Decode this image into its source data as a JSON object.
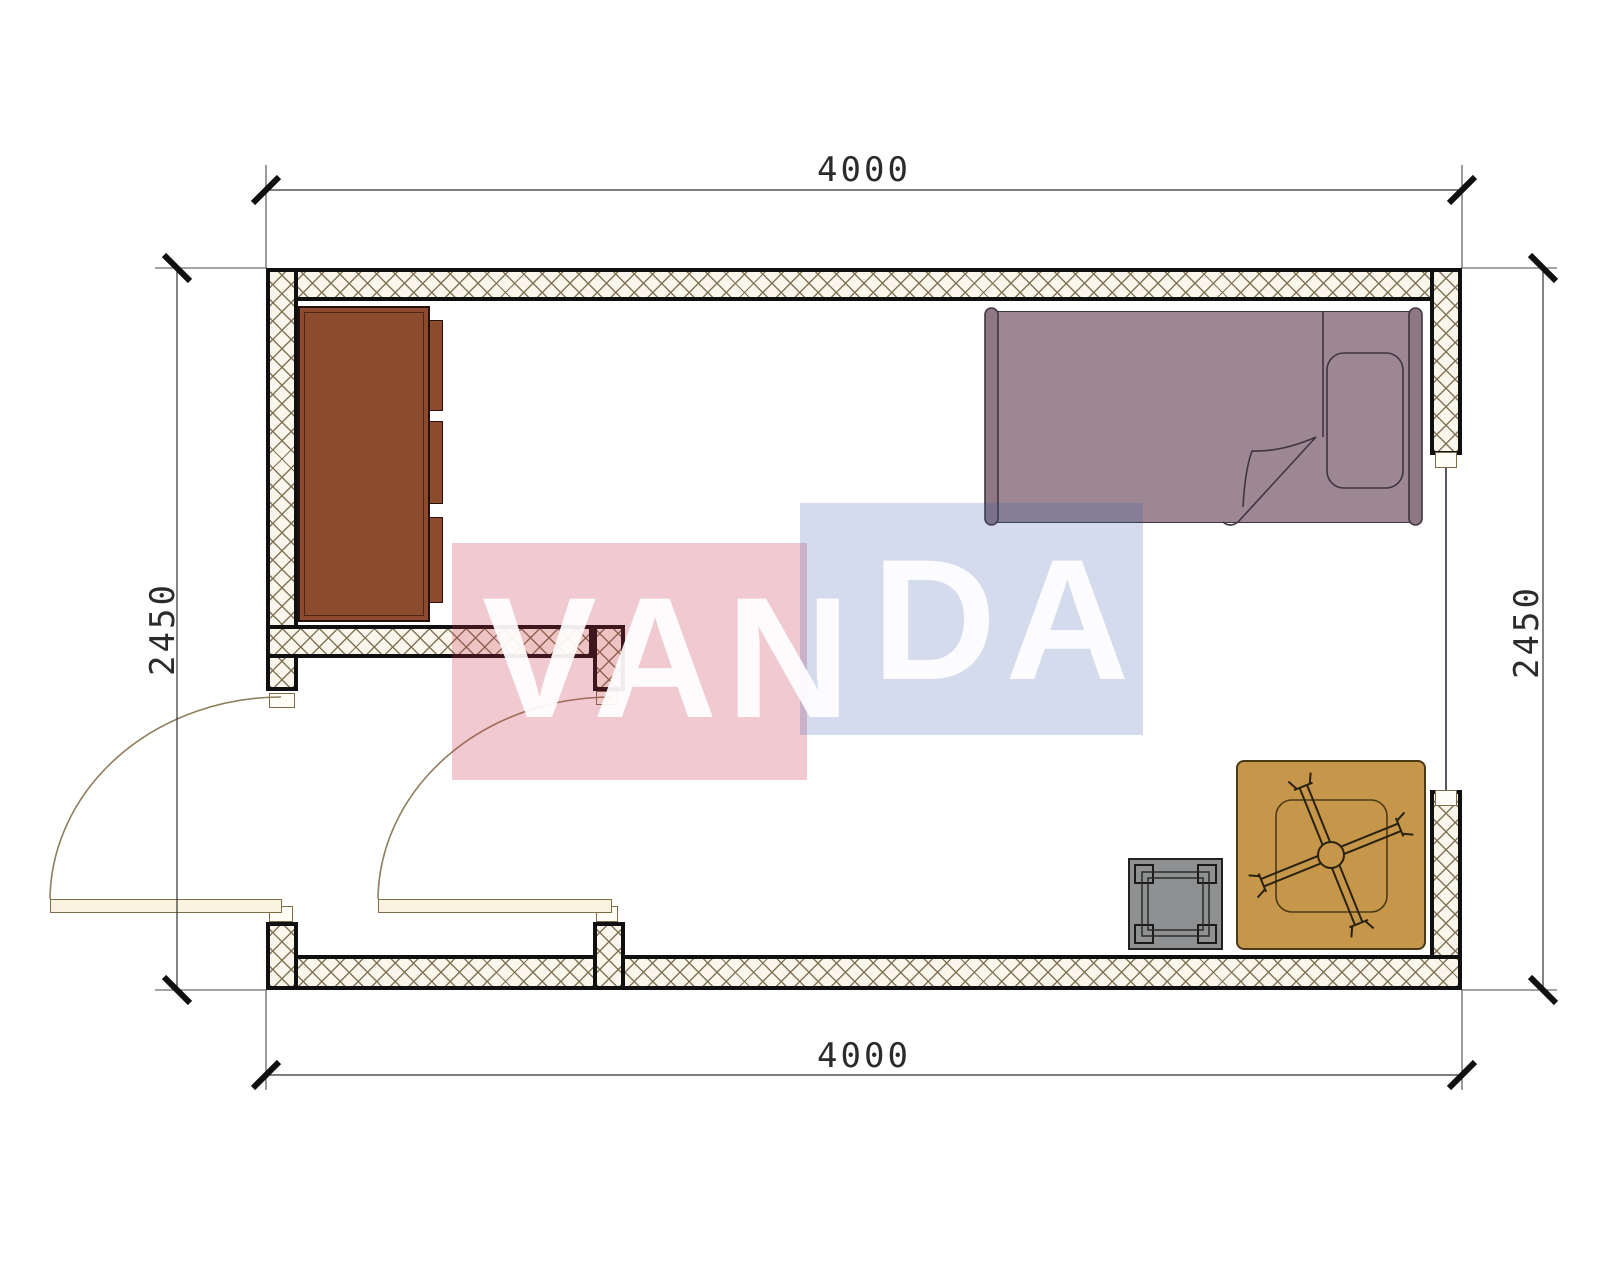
{
  "dimensions": {
    "top": "4000",
    "bottom": "4000",
    "left": "2450",
    "right": "2450"
  },
  "watermark": {
    "text": "VANDA",
    "part_left": "VAN",
    "part_right": "DA",
    "red_block_color": "rgba(200,42,72,0.25)",
    "blue_block_color": "rgba(58,92,168,0.22)"
  },
  "colors": {
    "wall_fill": "#faf6ec",
    "wall_hatch_line": "#7d6e50",
    "wall_border": "#101010",
    "wardrobe": "#8c4b2d",
    "bed": "#9c8792",
    "bed_outline": "#3f3542",
    "table": "#c6964a",
    "stool": "#8f9092",
    "door_leaf": "#faf3df",
    "dimension_text": "#2b2b2b"
  }
}
